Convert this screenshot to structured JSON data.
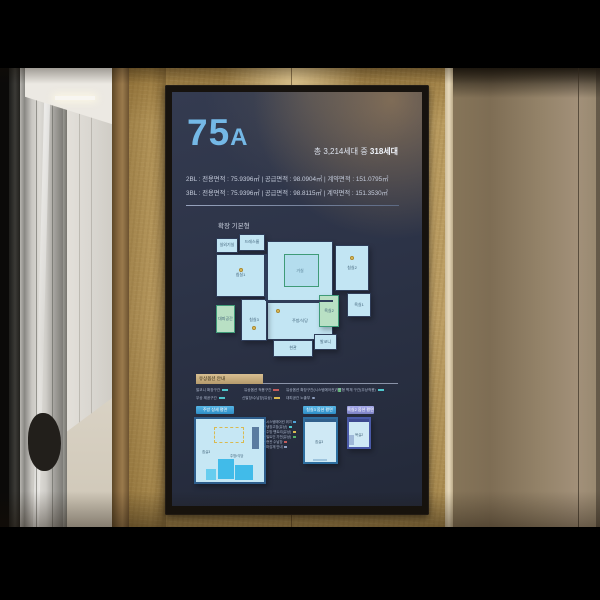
{
  "panel": {
    "unit_main": "75",
    "unit_sub": "A",
    "household_total_prefix": "총 3,214세대 중 ",
    "household_total_bold": "318세대",
    "area_lines": [
      "2BL : 전용면적 : 75.9396㎡   |   공급면적 : 98.0904㎡   |   계약면적 : 151.0795㎡",
      "3BL : 전용면적 : 75.9396㎡   |   공급면적 : 98.8115㎡   |   계약면적 : 151.3530㎡"
    ],
    "plan_type_label": "확장 기본형",
    "rooms": {
      "outdoor_unit": "실외기실",
      "dress": "드레스룸",
      "bed1": "침실1",
      "living": "거실",
      "bed2": "침실2",
      "bath1": "욕실1",
      "kitchen": "주방/식당",
      "bed3": "침실3",
      "shelter": "대피공간",
      "bath2": "욕실2",
      "entry": "현관",
      "balcony": "발코니"
    },
    "legend": {
      "header": "유상옵션 안내",
      "items": [
        {
          "label": "발코니 확장구간",
          "marker": "teal"
        },
        {
          "label": "유상옵션 적용구간",
          "marker": "red"
        },
        {
          "label": "유상옵션 확장구간(시스템에어컨)",
          "marker": "green-square"
        },
        {
          "label": "가변형 벽체 구간(무상적용)",
          "marker": "teal"
        },
        {
          "label": "무상 제공구간",
          "marker": "teal"
        },
        {
          "label": "신발장/수납장(유상)",
          "marker": "yellow"
        },
        {
          "label": "대피공간 노출부",
          "marker": "dot"
        }
      ]
    },
    "detail_plans": [
      {
        "title": "주방 상세 평면",
        "notes": [
          "시스템에어컨 위치",
          "냉장고장(유상)",
          "주방 팬트리(유상)",
          "빌트인 가전(유상)",
          "현관 수납장",
          "마감재 안내"
        ]
      },
      {
        "title": "침실3 옵션 평면"
      },
      {
        "title": "욕실2 옵션 평면"
      }
    ],
    "mini_labels": {
      "a1": "침실3",
      "a2": "주방/식당",
      "b": "침실3",
      "c": "욕실2"
    }
  },
  "colors": {
    "accent_blue": "#74b8e6",
    "screen_bg": "#2c3347",
    "plan_fill": "#c2e5f3",
    "plan_wall": "#2f3d59",
    "green_zone": "#b9e0c4",
    "legend_header_bg": "#c9b183",
    "mini_header_blue": "#3f9fd6",
    "mini_header_purple": "#9094d8",
    "wall_tan": "#b89a5e",
    "marker_yellow": "#e6c15c"
  }
}
